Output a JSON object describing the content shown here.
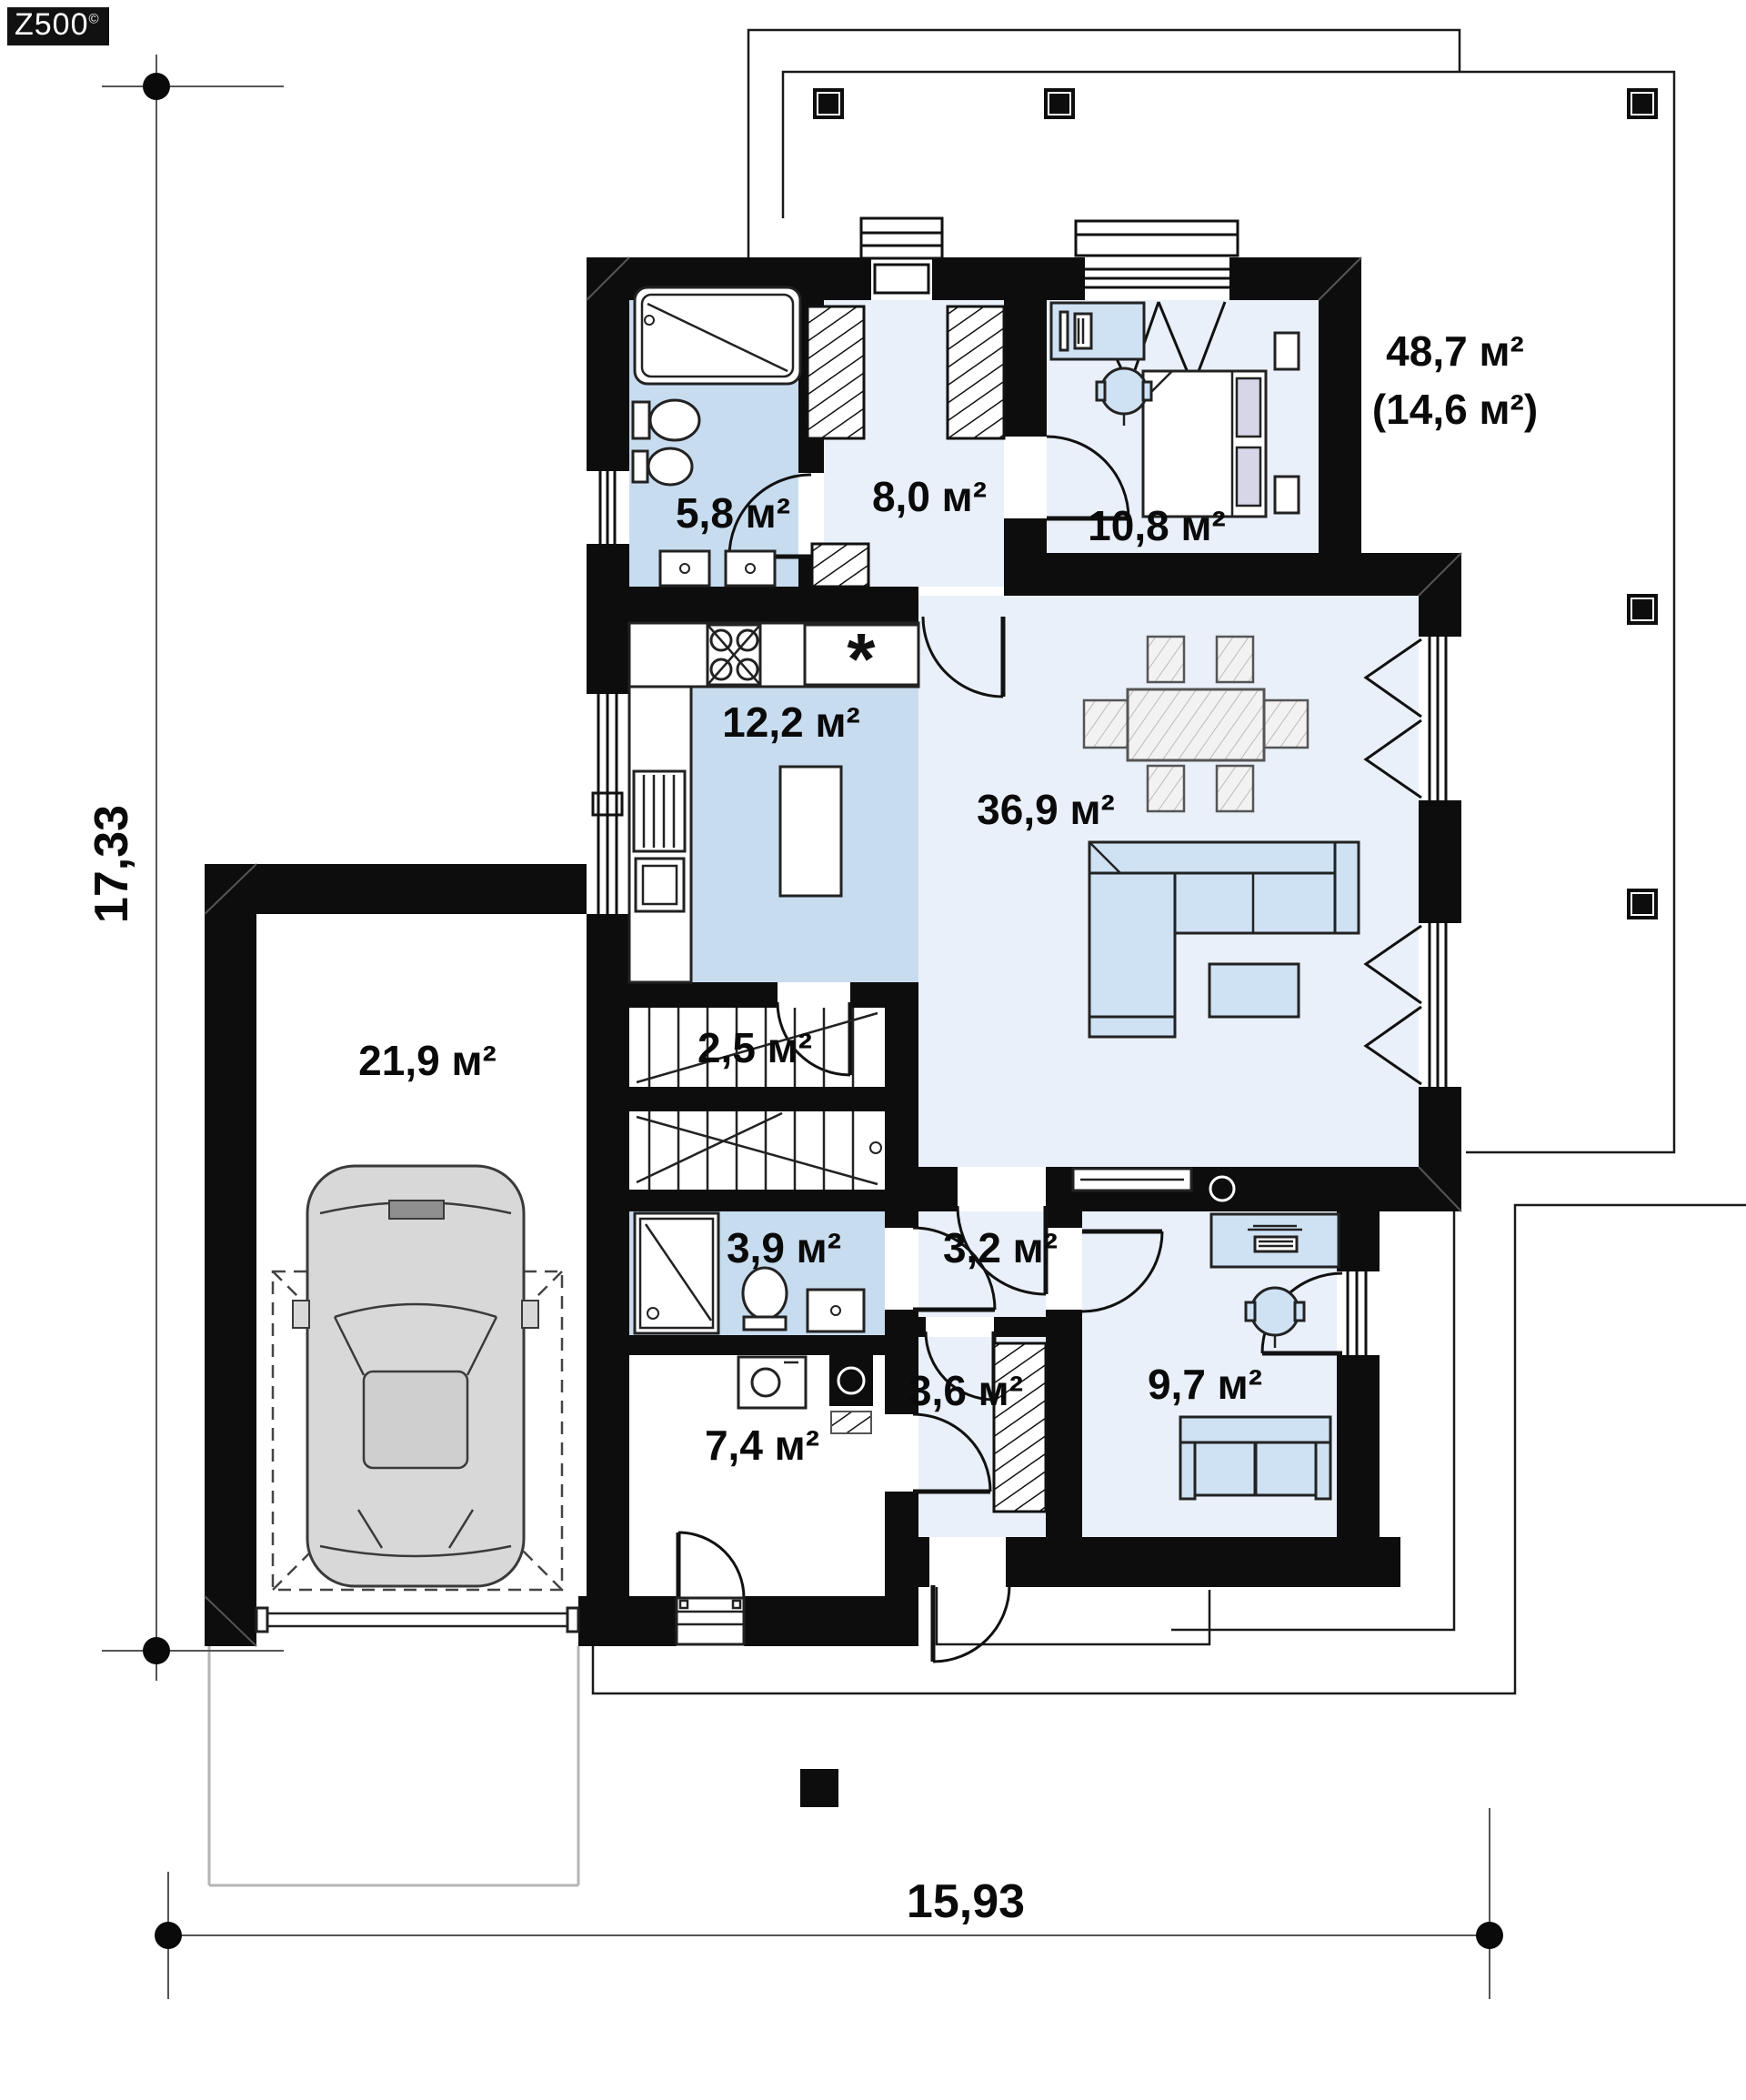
{
  "logo": {
    "brand": "Z500",
    "copyright": "©"
  },
  "dimensions": {
    "left": "17,33",
    "bottom": "15,93"
  },
  "terrace_label": {
    "line1": "48,7 м²",
    "line2": "(14,6 м²)"
  },
  "rooms": [
    {
      "id": "bathroom-top",
      "area": "5,8 м²"
    },
    {
      "id": "hallway",
      "area": "8,0 м²"
    },
    {
      "id": "bedroom",
      "area": "10,8 м²"
    },
    {
      "id": "kitchen",
      "area": "12,2 м²"
    },
    {
      "id": "living-room",
      "area": "36,9 м²"
    },
    {
      "id": "stairs",
      "area": "2,5 м²"
    },
    {
      "id": "garage",
      "area": "21,9 м²"
    },
    {
      "id": "bathroom-bottom",
      "area": "3,9 м²"
    },
    {
      "id": "hall",
      "area": "3,2 м²"
    },
    {
      "id": "entry",
      "area": "3,6 м²"
    },
    {
      "id": "utility",
      "area": "7,4 м²"
    },
    {
      "id": "office",
      "area": "9,7 м²"
    }
  ],
  "symbols": {
    "kitchen_sink": "*"
  },
  "colors": {
    "wall": "#0d0d0d",
    "room_light": "#e9f0f9",
    "room_medium": "#c8dcef",
    "furniture_blue": "#cfe2f4",
    "car_gray": "#d8d8d8"
  }
}
